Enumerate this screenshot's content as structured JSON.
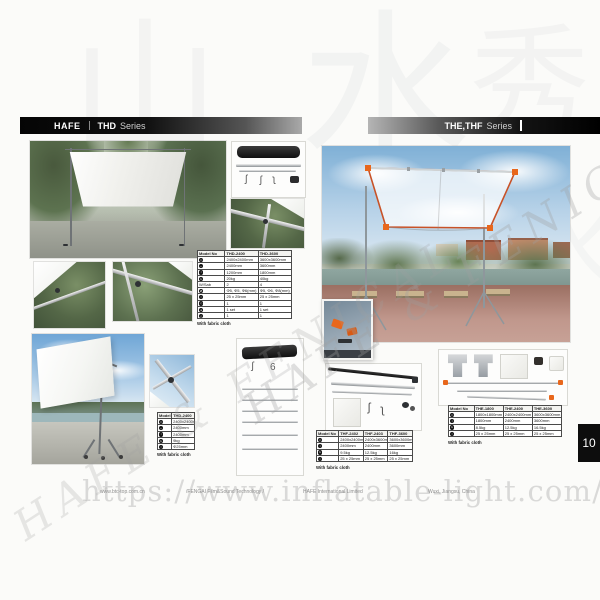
{
  "page": {
    "header_left": {
      "brand": "HAFE",
      "series": "THD",
      "suffix": "Series"
    },
    "header_right": {
      "series": "THE,THF",
      "suffix": "Series"
    },
    "page_number": "10",
    "footer": {
      "website": "www.btc-top.com.cn",
      "company_line": "/FENGAI Film&Sound Technology /",
      "company": "HAFE International Limited",
      "location": "Wuxi, Jiangsu, China"
    },
    "watermarks": {
      "url": "https://www.inflatable-light.com/",
      "diagonal": "HAFE & FENICAL",
      "chinese": [
        "水",
        "山",
        "秀",
        "水"
      ]
    }
  },
  "tables": {
    "thd_main": {
      "header": [
        "Model No",
        "THD-2400",
        "THD-3600"
      ],
      "rows": [
        {
          "icon": "frame-size-icon",
          "cells": [
            "2400x2400mm",
            "3600x3600mm"
          ]
        },
        {
          "icon": "width-icon",
          "cells": [
            "2400mm",
            "3600mm"
          ]
        },
        {
          "icon": "height-icon",
          "cells": [
            "1200mm",
            "1800mm"
          ]
        },
        {
          "icon": "weight-icon",
          "cells": [
            "20kg",
            "40kg"
          ]
        },
        {
          "label": "W/Sab",
          "cells": [
            "2",
            "4"
          ]
        },
        {
          "icon": "tube-diameter-icon",
          "cells": [
            "Φ5, Φ5, Φ6(mm)",
            "Φ5, Φ6, Φ8(mm)"
          ]
        },
        {
          "icon": "profile-icon",
          "cells": [
            "25 x 25mm",
            "25 x 25mm"
          ]
        },
        {
          "icon": "bag-icon",
          "cells": [
            "1",
            "1"
          ]
        },
        {
          "icon": "cloth-icon",
          "cells": [
            "1 set",
            "1 set"
          ]
        },
        {
          "icon": "hook-icon",
          "cells": [
            "1",
            "1"
          ]
        }
      ],
      "note": "With fabric cloth"
    },
    "thd_small": {
      "header": [
        "Model No",
        "THD-2400"
      ],
      "rows": [
        {
          "icon": "frame-size-icon",
          "cells": [
            "2400x2400mm"
          ]
        },
        {
          "icon": "width-icon",
          "cells": [
            "2400mm"
          ]
        },
        {
          "icon": "height-icon",
          "cells": [
            "2400mm"
          ]
        },
        {
          "icon": "weight-icon",
          "cells": [
            "9kg"
          ]
        },
        {
          "icon": "profile-icon",
          "cells": [
            "Φ25mm"
          ]
        }
      ],
      "note": "With fabric cloth"
    },
    "thf": {
      "header": [
        "Model No",
        "THF-2402",
        "THF-2403",
        "THF-3600"
      ],
      "rows": [
        {
          "icon": "frame-size-icon",
          "cells": [
            "2400x2400mm",
            "2400x3600mm",
            "3600x3600mm"
          ]
        },
        {
          "icon": "height-icon",
          "cells": [
            "2400mm",
            "2400mm",
            "3600mm"
          ]
        },
        {
          "icon": "weight-icon",
          "cells": [
            "9.5kg",
            "12.5kg",
            "16kg"
          ]
        },
        {
          "icon": "profile-icon",
          "cells": [
            "25 x 25mm",
            "25 x 25mm",
            "25 x 25mm"
          ]
        }
      ],
      "note": "With fabric cloth"
    },
    "the": {
      "header": [
        "Model No",
        "THE-1800",
        "THE-2400",
        "THE-3600"
      ],
      "rows": [
        {
          "icon": "frame-size-icon",
          "cells": [
            "1800x1800mm",
            "2400x2400mm",
            "3600x3600mm"
          ]
        },
        {
          "icon": "height-icon",
          "cells": [
            "1800mm",
            "2400mm",
            "3600mm"
          ]
        },
        {
          "icon": "weight-icon",
          "cells": [
            "8.5kg",
            "12.5kg",
            "16.5kg"
          ]
        },
        {
          "icon": "profile-icon",
          "cells": [
            "25 x 25mm",
            "25 x 25mm",
            "25 x 25mm"
          ]
        }
      ],
      "note": "With fabric cloth"
    }
  },
  "colors": {
    "accent_orange": "#e8671c",
    "frame_red": "#c85228",
    "header_black": "#0d0d0d"
  }
}
